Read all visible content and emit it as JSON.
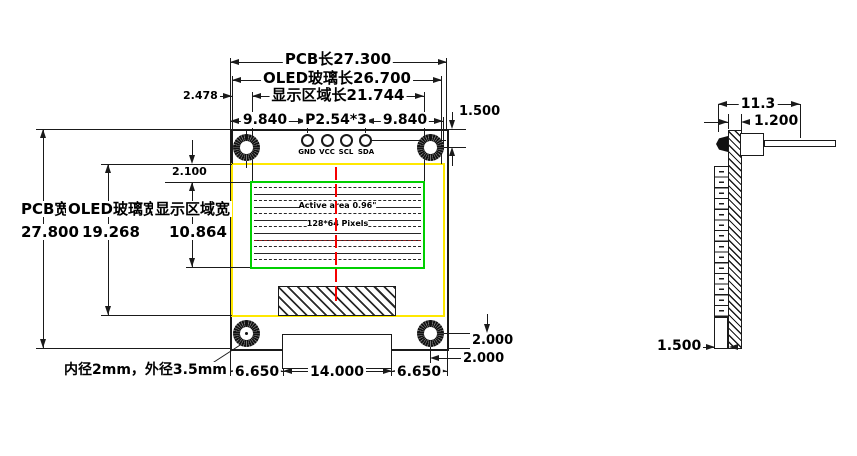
{
  "drawing": {
    "type": "OLED module dimensional drawing",
    "front": {
      "top_dims": {
        "pcb_len": "PCB长27.300",
        "glass_len": "OLED玻璃长26.700",
        "area_len": "显示区域长21.744",
        "offset": "2.478",
        "pin_left": "9.840",
        "pitch": "P2.54*3",
        "pin_right": "9.840",
        "hole_top": "1.500"
      },
      "left_dims": {
        "pcb_w_label": "PCB宽",
        "pcb_w_value": "27.800",
        "glass_w_label": "OLED玻璃宽",
        "glass_w_value": "19.268",
        "area_w_label": "显示区域宽",
        "area_w_value": "10.864",
        "gap": "2.100"
      },
      "pins": {
        "p1": "GND",
        "p2": "VCC",
        "p3": "SCL",
        "p4": "SDA"
      },
      "screen": {
        "line1": "Active area 0.96\"",
        "line2": "128*64 Pixels"
      },
      "bottom_dims": {
        "hole_note": "内径2mm，外径3.5mm",
        "left": "6.650",
        "center": "14.000",
        "right": "6.650",
        "hole_v": "2.000",
        "hole_h": "2.000"
      }
    },
    "side": {
      "width_total": "11.3",
      "pcb_thickness": "1.200",
      "bottom_thickness": "1.500"
    },
    "colors": {
      "glass_outline": "#ffe800",
      "active_area_outline": "#00cf00",
      "centerline": "#f50000",
      "ink": "#1a1a1a"
    }
  }
}
